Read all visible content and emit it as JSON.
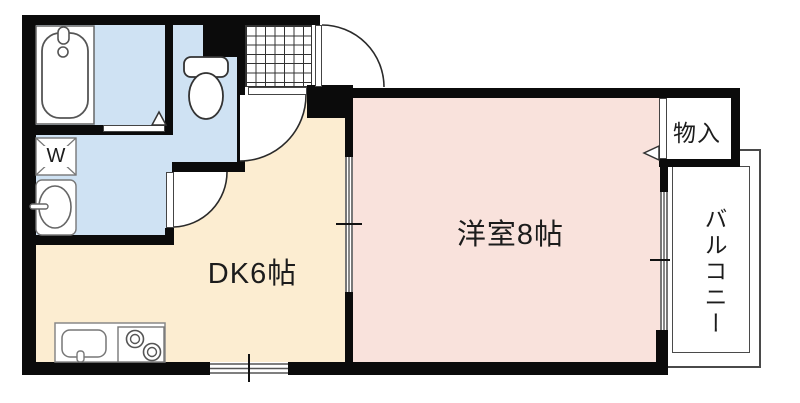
{
  "plan": {
    "rooms": {
      "dining_kitchen": {
        "label": "DK6帖"
      },
      "western_room": {
        "label": "洋室8帖"
      },
      "storage": {
        "label": "物入"
      },
      "balcony": {
        "label": "バルコニー"
      },
      "washer": {
        "label": "W"
      }
    },
    "colors": {
      "wall": "#0b0b0b",
      "wet_floor": "#cfe2f3",
      "dk_floor": "#fcedd1",
      "room_floor": "#f9e2dc",
      "fixture_line": "#4a4a4a"
    }
  }
}
